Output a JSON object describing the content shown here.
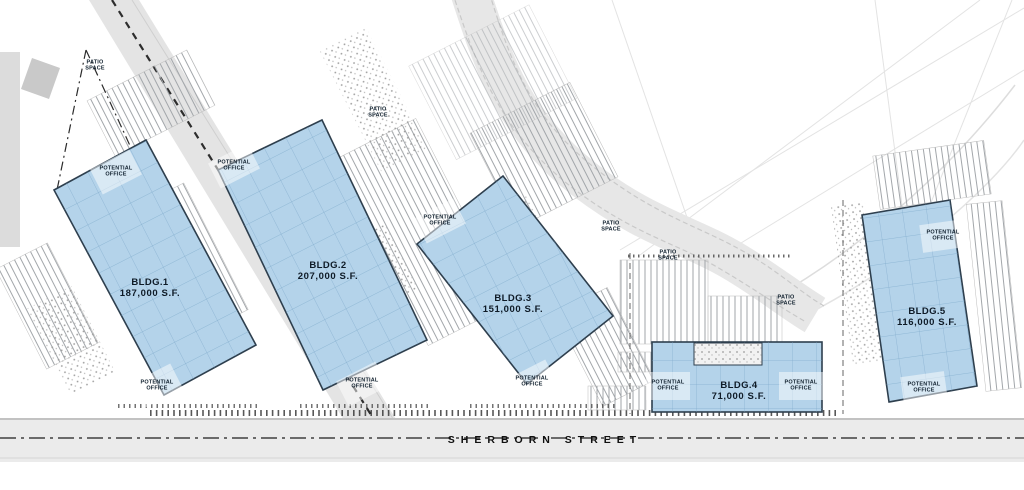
{
  "street": {
    "name": "SHERBORN STREET"
  },
  "buildings": [
    {
      "name": "BLDG.1",
      "area": "187,000 S.F."
    },
    {
      "name": "BLDG.2",
      "area": "207,000 S.F."
    },
    {
      "name": "BLDG.3",
      "area": "151,000 S.F."
    },
    {
      "name": "BLDG.4",
      "area": "71,000 S.F."
    },
    {
      "name": "BLDG.5",
      "area": "116,000 S.F."
    }
  ],
  "labels": {
    "patio_space": "PATIO SPACE",
    "potential_office": "POTENTIAL OFFICE"
  },
  "colors": {
    "building_fill": "#b4d3ea",
    "building_stroke": "#2e3f4e",
    "road_fill": "#e4e4e4",
    "label_text": "#10202e"
  }
}
